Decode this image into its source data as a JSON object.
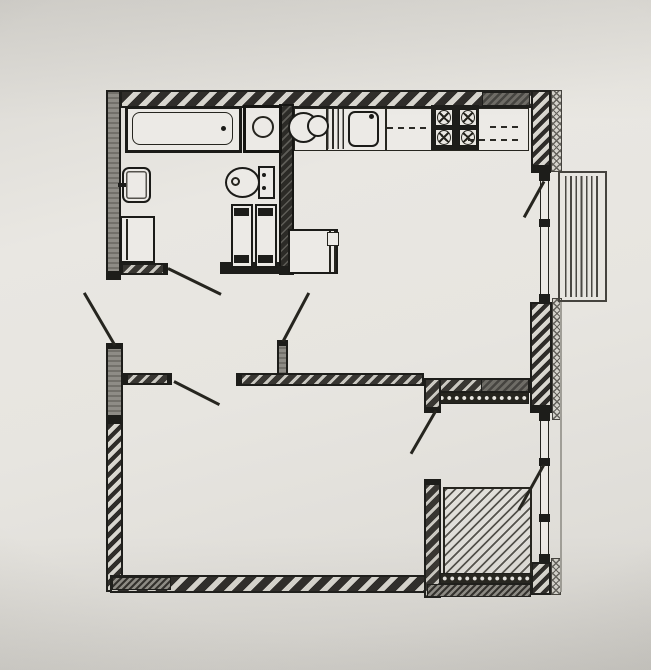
{
  "meta": {
    "title": "apartment-floor-plan",
    "paper_color": "#e7e5e0",
    "ink_color": "#26251f",
    "wall_gray": "#8e8c86"
  },
  "rooms": [
    "bathroom",
    "hallway",
    "kitchen-living-room",
    "bedroom-living-room",
    "storage-loggia",
    "balcony"
  ],
  "elements": [
    {
      "name": "wall-top",
      "cls": "ext-h",
      "x": 120,
      "y": 90,
      "w": 440,
      "h": 18
    },
    {
      "name": "wall-top-dark-block",
      "cls": "dark-block",
      "x": 482,
      "y": 92,
      "w": 48,
      "h": 14
    },
    {
      "name": "wall-left-upper",
      "cls": "gray-v",
      "x": 106,
      "y": 90,
      "w": 15,
      "h": 183
    },
    {
      "name": "wall-left-upper-cap",
      "cls": "black",
      "x": 106,
      "y": 273,
      "w": 15,
      "h": 7
    },
    {
      "name": "wall-left-pier",
      "cls": "gray-v",
      "x": 106,
      "y": 343,
      "w": 17,
      "h": 79
    },
    {
      "name": "wall-left-pier-cap-top",
      "cls": "black",
      "x": 106,
      "y": 343,
      "w": 17,
      "h": 6
    },
    {
      "name": "wall-left-pier-cap-bottom",
      "cls": "black",
      "x": 106,
      "y": 415,
      "w": 17,
      "h": 7
    },
    {
      "name": "wall-left-lower",
      "cls": "ext-h-f",
      "x": 106,
      "y": 422,
      "w": 17,
      "h": 170
    },
    {
      "name": "wall-right-upper",
      "cls": "ext-h-f",
      "x": 531,
      "y": 90,
      "w": 20,
      "h": 77
    },
    {
      "name": "wall-right-upper-cap",
      "cls": "black",
      "x": 531,
      "y": 166,
      "w": 20,
      "h": 7
    },
    {
      "name": "wall-right-upper-outer",
      "cls": "cross",
      "x": 551,
      "y": 90,
      "w": 11,
      "h": 82
    },
    {
      "name": "balcony-door-glazing",
      "cls": "win",
      "x": 540,
      "y": 173,
      "w": 9,
      "h": 129
    },
    {
      "name": "glazing-cap",
      "cls": "black",
      "x": 539,
      "y": 173,
      "w": 11,
      "h": 8
    },
    {
      "name": "glazing-cap",
      "cls": "black",
      "x": 539,
      "y": 219,
      "w": 11,
      "h": 8
    },
    {
      "name": "glazing-cap",
      "cls": "black",
      "x": 539,
      "y": 294,
      "w": 11,
      "h": 8
    },
    {
      "name": "wall-right-mid",
      "cls": "ext-h-f",
      "x": 530,
      "y": 302,
      "w": 22,
      "h": 105
    },
    {
      "name": "wall-right-mid-cap",
      "cls": "black",
      "x": 530,
      "y": 407,
      "w": 22,
      "h": 6
    },
    {
      "name": "wall-right-mid-outer",
      "cls": "cross",
      "x": 552,
      "y": 298,
      "w": 10,
      "h": 122
    },
    {
      "name": "storage-window-glazing",
      "cls": "win",
      "x": 540,
      "y": 413,
      "w": 9,
      "h": 149
    },
    {
      "name": "glazing-cap",
      "cls": "black",
      "x": 539,
      "y": 413,
      "w": 11,
      "h": 8
    },
    {
      "name": "glazing-cap",
      "cls": "black",
      "x": 539,
      "y": 458,
      "w": 11,
      "h": 8
    },
    {
      "name": "glazing-cap",
      "cls": "black",
      "x": 539,
      "y": 514,
      "w": 11,
      "h": 8
    },
    {
      "name": "glazing-cap",
      "cls": "black",
      "x": 539,
      "y": 554,
      "w": 11,
      "h": 8
    },
    {
      "name": "wall-right-lower",
      "cls": "ext-h-f",
      "x": 531,
      "y": 562,
      "w": 20,
      "h": 33
    },
    {
      "name": "wall-right-lower-outer",
      "cls": "cross",
      "x": 551,
      "y": 558,
      "w": 10,
      "h": 37
    },
    {
      "name": "facade-line",
      "cls": "thin-v",
      "x": 560,
      "y": 302,
      "w": 2,
      "h": 290
    },
    {
      "name": "wall-bottom",
      "cls": "ext-h",
      "x": 110,
      "y": 575,
      "w": 320,
      "h": 18
    },
    {
      "name": "wall-bottom-dark-block",
      "cls": "fine-dark",
      "x": 112,
      "y": 577,
      "w": 59,
      "h": 13
    },
    {
      "name": "bathroom-partition",
      "cls": "part-dark",
      "x": 279,
      "y": 104,
      "w": 15,
      "h": 171
    },
    {
      "name": "bathroom-partition-cap",
      "cls": "black",
      "x": 279,
      "y": 266,
      "w": 15,
      "h": 9
    },
    {
      "name": "bathroom-bottom-wall",
      "cls": "int-h",
      "x": 121,
      "y": 263,
      "w": 46,
      "h": 12
    },
    {
      "name": "bathroom-bottom-wall-cap",
      "cls": "black",
      "x": 163,
      "y": 263,
      "w": 5,
      "h": 12
    },
    {
      "name": "bathroom-bottom-wall-black",
      "cls": "black",
      "x": 220,
      "y": 262,
      "w": 59,
      "h": 12
    },
    {
      "name": "hall-wall-a",
      "cls": "int-h",
      "x": 123,
      "y": 373,
      "w": 49,
      "h": 12
    },
    {
      "name": "hall-wall-a-cap-left",
      "cls": "black",
      "x": 123,
      "y": 373,
      "w": 5,
      "h": 12
    },
    {
      "name": "hall-wall-a-cap-right",
      "cls": "black",
      "x": 167,
      "y": 373,
      "w": 5,
      "h": 12
    },
    {
      "name": "hall-wall-b",
      "cls": "int-h",
      "x": 236,
      "y": 373,
      "w": 188,
      "h": 13
    },
    {
      "name": "hall-wall-b-cap",
      "cls": "black",
      "x": 236,
      "y": 373,
      "w": 6,
      "h": 13
    },
    {
      "name": "hall-wall-stub",
      "cls": "gray-v",
      "x": 277,
      "y": 340,
      "w": 11,
      "h": 35
    },
    {
      "name": "hall-wall-stub-cap",
      "cls": "black",
      "x": 277,
      "y": 340,
      "w": 11,
      "h": 6
    },
    {
      "name": "storage-top-wall",
      "cls": "int-h",
      "x": 424,
      "y": 378,
      "w": 106,
      "h": 15
    },
    {
      "name": "storage-top-dark-block",
      "cls": "dark-block",
      "x": 481,
      "y": 379,
      "w": 48,
      "h": 13
    },
    {
      "name": "storage-insulation-top",
      "cls": "dots",
      "x": 437,
      "y": 392,
      "w": 92,
      "h": 12
    },
    {
      "name": "storage-left-wall-upper",
      "cls": "int-h",
      "x": 424,
      "y": 378,
      "w": 17,
      "h": 35
    },
    {
      "name": "storage-left-wall-upper-cap",
      "cls": "black",
      "x": 424,
      "y": 407,
      "w": 17,
      "h": 6
    },
    {
      "name": "storage-left-wall-lower",
      "cls": "int-h",
      "x": 424,
      "y": 479,
      "w": 17,
      "h": 119
    },
    {
      "name": "storage-left-wall-lower-cap",
      "cls": "black",
      "x": 424,
      "y": 479,
      "w": 17,
      "h": 6
    },
    {
      "name": "storage-hatched-area",
      "cls": "sq-hatch",
      "x": 443,
      "y": 487,
      "w": 89,
      "h": 88
    },
    {
      "name": "storage-insulation-bottom",
      "cls": "dots",
      "x": 440,
      "y": 573,
      "w": 91,
      "h": 11
    },
    {
      "name": "storage-wall-bottom",
      "cls": "fine-dark",
      "x": 427,
      "y": 584,
      "w": 104,
      "h": 13
    },
    {
      "name": "kitchen-counter",
      "cls": "fix-b15",
      "x": 294,
      "y": 108,
      "w": 235,
      "h": 43
    },
    {
      "name": "counter-divider",
      "cls": "vline",
      "x": 326,
      "y": 108,
      "w": 2,
      "h": 43
    },
    {
      "name": "counter-divider",
      "cls": "vline",
      "x": 385,
      "y": 108,
      "w": 2,
      "h": 43
    },
    {
      "name": "drainboard",
      "cls": "vstripes",
      "x": 327,
      "y": 109,
      "w": 20,
      "h": 40
    },
    {
      "name": "kitchen-sink",
      "cls": "fix-r2",
      "x": 348,
      "y": 111,
      "w": 31,
      "h": 36
    },
    {
      "name": "kitchen-faucet",
      "cls": "dot",
      "x": 369,
      "y": 114,
      "w": 5,
      "h": 5
    },
    {
      "name": "upper-cabinet-dash",
      "cls": "dash-h",
      "x": 387,
      "y": 127,
      "w": 42,
      "h": 2
    },
    {
      "name": "stove",
      "cls": "black",
      "x": 431,
      "y": 105,
      "w": 48,
      "h": 45
    },
    {
      "name": "stove-cell",
      "cls": "cell",
      "x": 435,
      "y": 109,
      "w": 18,
      "h": 17
    },
    {
      "name": "stove-cell",
      "cls": "cell",
      "x": 459,
      "y": 109,
      "w": 18,
      "h": 17
    },
    {
      "name": "stove-cell",
      "cls": "cell",
      "x": 435,
      "y": 129,
      "w": 18,
      "h": 17
    },
    {
      "name": "stove-cell",
      "cls": "cell",
      "x": 459,
      "y": 129,
      "w": 18,
      "h": 17
    },
    {
      "name": "burner-icon",
      "cls": "burner",
      "x": 437,
      "y": 110,
      "w": 14,
      "h": 15
    },
    {
      "name": "burner-icon",
      "cls": "burner",
      "x": 461,
      "y": 110,
      "w": 14,
      "h": 15
    },
    {
      "name": "burner-icon",
      "cls": "burner",
      "x": 437,
      "y": 130,
      "w": 14,
      "h": 15
    },
    {
      "name": "burner-icon",
      "cls": "burner",
      "x": 461,
      "y": 130,
      "w": 14,
      "h": 15
    },
    {
      "name": "upper-cabinet-dash",
      "cls": "dash-h",
      "x": 468,
      "y": 139,
      "w": 52,
      "h": 2
    },
    {
      "name": "upper-cabinet-dash",
      "cls": "dash-h",
      "x": 490,
      "y": 126,
      "w": 30,
      "h": 2
    },
    {
      "name": "hand-basin",
      "cls": "stadium",
      "x": 288,
      "y": 112,
      "w": 31,
      "h": 31
    },
    {
      "name": "hand-basin-bowl",
      "cls": "ringfill",
      "x": 307,
      "y": 115,
      "w": 22,
      "h": 22
    },
    {
      "name": "fridge",
      "cls": "fix-b2",
      "x": 288,
      "y": 229,
      "w": 50,
      "h": 45
    },
    {
      "name": "fridge-door-line",
      "cls": "vline",
      "x": 329,
      "y": 231,
      "w": 2,
      "h": 41
    },
    {
      "name": "fridge-door-line",
      "cls": "vline",
      "x": 334,
      "y": 231,
      "w": 2,
      "h": 41
    },
    {
      "name": "fridge-hinge",
      "cls": "fix-b15",
      "x": 327,
      "y": 232,
      "w": 12,
      "h": 14
    },
    {
      "name": "bathtub",
      "cls": "fix-b3",
      "x": 125,
      "y": 106,
      "w": 117,
      "h": 47
    },
    {
      "name": "bathtub-inner",
      "cls": "fix-r15",
      "x": 132,
      "y": 112,
      "w": 101,
      "h": 33
    },
    {
      "name": "bathtub-drain",
      "cls": "dot",
      "x": 221,
      "y": 126,
      "w": 5,
      "h": 5
    },
    {
      "name": "washing-machine",
      "cls": "wm",
      "x": 243,
      "y": 105,
      "w": 39,
      "h": 48
    },
    {
      "name": "washing-machine-drum-icon",
      "cls": "ring",
      "x": 252,
      "y": 116,
      "w": 22,
      "h": 22
    },
    {
      "name": "washbasin",
      "cls": "fix-r2 dbl",
      "x": 122,
      "y": 167,
      "w": 29,
      "h": 36
    },
    {
      "name": "washbasin-tap",
      "cls": "black",
      "x": 118,
      "y": 183,
      "w": 8,
      "h": 4
    },
    {
      "name": "washer-cabinet",
      "cls": "fix-b2",
      "x": 120,
      "y": 216,
      "w": 35,
      "h": 47
    },
    {
      "name": "washer-cabinet-line",
      "cls": "vline",
      "x": 126,
      "y": 219,
      "w": 2,
      "h": 41
    },
    {
      "name": "toilet-bowl",
      "cls": "ellipse",
      "x": 225,
      "y": 167,
      "w": 35,
      "h": 31
    },
    {
      "name": "toilet-flush-icon",
      "cls": "ring",
      "x": 231,
      "y": 177,
      "w": 9,
      "h": 9
    },
    {
      "name": "toilet-tank",
      "cls": "fix-b2",
      "x": 258,
      "y": 166,
      "w": 17,
      "h": 33
    },
    {
      "name": "toilet-tank-dot",
      "cls": "dot",
      "x": 262,
      "y": 173,
      "w": 4,
      "h": 4
    },
    {
      "name": "toilet-tank-dot",
      "cls": "dot",
      "x": 262,
      "y": 186,
      "w": 4,
      "h": 4
    },
    {
      "name": "tall-unit",
      "cls": "fix-b2",
      "x": 231,
      "y": 204,
      "w": 22,
      "h": 64
    },
    {
      "name": "tall-unit-cap",
      "cls": "black",
      "x": 234,
      "y": 208,
      "w": 15,
      "h": 8
    },
    {
      "name": "tall-unit-cap",
      "cls": "black",
      "x": 234,
      "y": 255,
      "w": 15,
      "h": 8
    },
    {
      "name": "tall-unit",
      "cls": "fix-b2",
      "x": 255,
      "y": 204,
      "w": 22,
      "h": 64
    },
    {
      "name": "tall-unit-cap",
      "cls": "black",
      "x": 258,
      "y": 208,
      "w": 15,
      "h": 8
    },
    {
      "name": "tall-unit-cap",
      "cls": "black",
      "x": 258,
      "y": 255,
      "w": 15,
      "h": 8
    },
    {
      "name": "balcony-frame",
      "cls": "fix-b2l",
      "x": 558,
      "y": 171,
      "w": 49,
      "h": 131
    },
    {
      "name": "balcony-decking",
      "cls": "vstripes2",
      "x": 565,
      "y": 176,
      "w": 36,
      "h": 121
    },
    {
      "name": "entrance-door-leaf",
      "cls": "leaf",
      "x": 115,
      "y": 344,
      "w": 61,
      "h": 3,
      "rot": -120.3
    },
    {
      "name": "bathroom-door-leaf",
      "cls": "leaf",
      "x": 168,
      "y": 267,
      "w": 59,
      "h": 3,
      "rot": 26
    },
    {
      "name": "kitchen-door-leaf",
      "cls": "leaf",
      "x": 283,
      "y": 340,
      "w": 55,
      "h": 3,
      "rot": -62
    },
    {
      "name": "living-room-door-leaf",
      "cls": "leaf",
      "x": 174,
      "y": 380,
      "w": 51,
      "h": 3,
      "rot": 27
    },
    {
      "name": "balcony-door-leaf",
      "cls": "leaf",
      "x": 544,
      "y": 180,
      "w": 41,
      "h": 3,
      "rot": 119
    },
    {
      "name": "storage-right-door-leaf",
      "cls": "leaf",
      "x": 544,
      "y": 463,
      "w": 52,
      "h": 3,
      "rot": 119
    },
    {
      "name": "storage-left-door-leaf",
      "cls": "leaf",
      "x": 436,
      "y": 409,
      "w": 50,
      "h": 3,
      "rot": 120
    }
  ]
}
